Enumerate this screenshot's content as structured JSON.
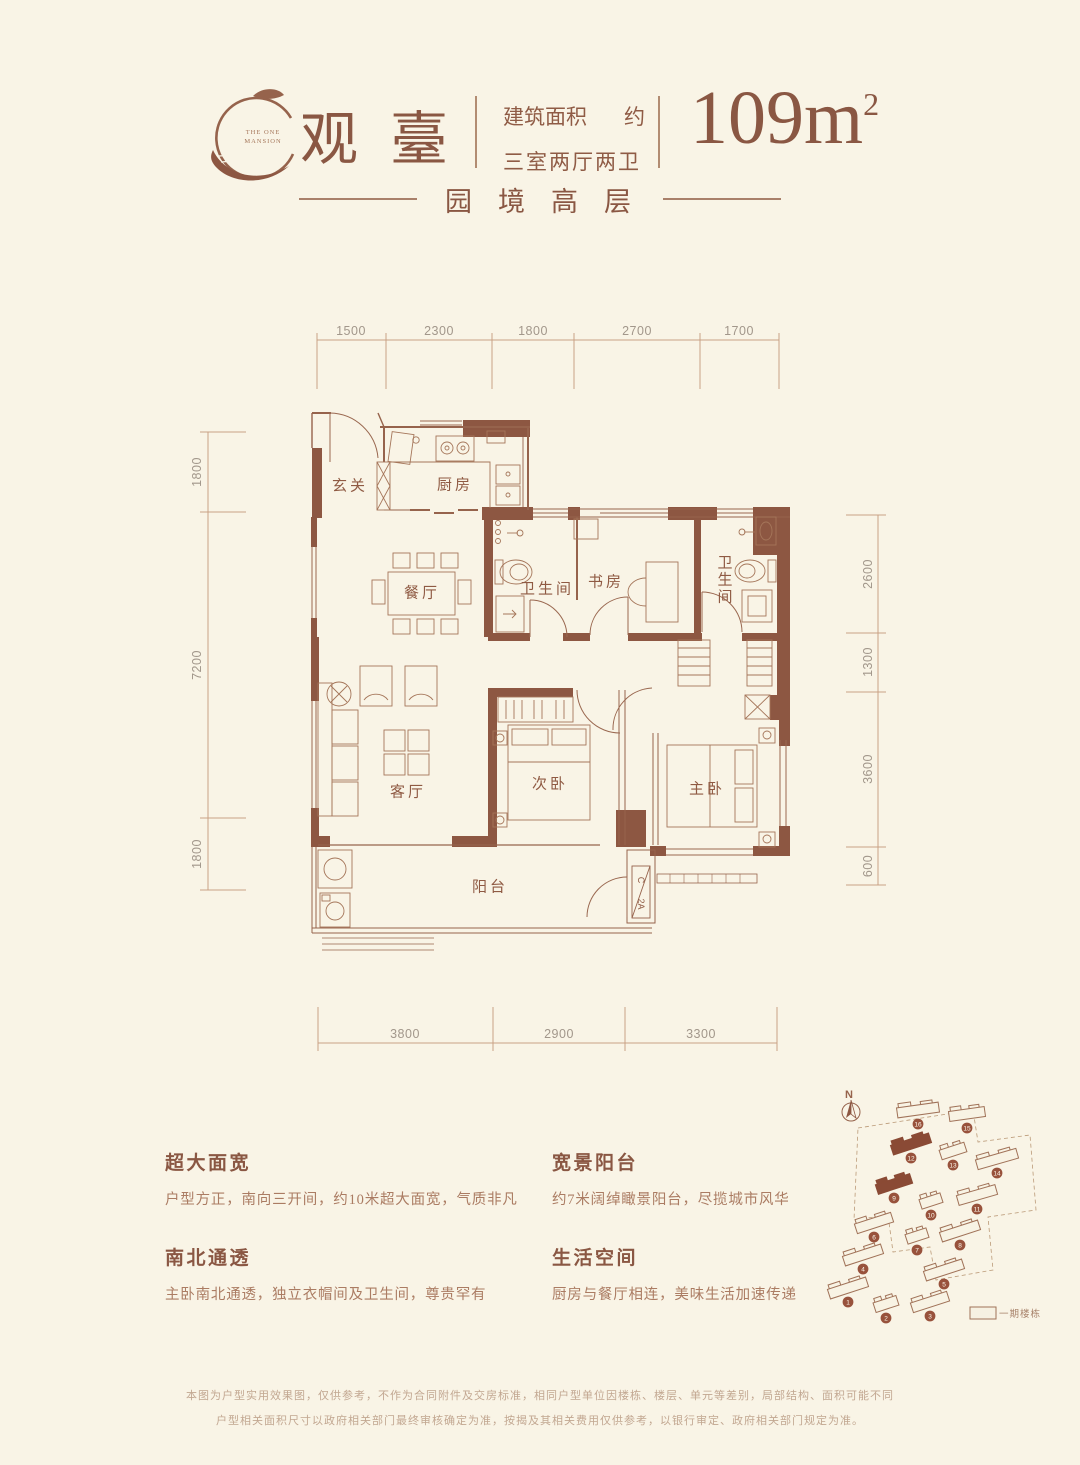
{
  "header": {
    "logo_caption_1": "THE ONE",
    "logo_caption_2": "MANSION",
    "title": "观臺",
    "area_label": "建筑面积",
    "area_approx": "约",
    "layout_label": "三室两厅两卫",
    "area_value": "109m",
    "area_sup": "2",
    "subtitle": "园境高层"
  },
  "floorplan": {
    "rooms": {
      "foyer": "玄关",
      "kitchen": "厨房",
      "dining": "餐厅",
      "bath1": "卫生间",
      "study": "书房",
      "bath2": "卫生间",
      "living": "客厅",
      "bedroom2": "次卧",
      "master": "主卧",
      "balcony": "阳台"
    },
    "ac_top": "C",
    "ac_bottom": "2A",
    "dims": {
      "top": [
        "1500",
        "2300",
        "1800",
        "2700",
        "1700"
      ],
      "left": [
        "1800",
        "7200",
        "1800"
      ],
      "right": [
        "2600",
        "1300",
        "3600",
        "600"
      ],
      "bottom": [
        "3800",
        "2900",
        "3300"
      ]
    }
  },
  "features": [
    {
      "title": "超大面宽",
      "desc": "户型方正，南向三开间，约10米超大面宽，气质非凡"
    },
    {
      "title": "南北通透",
      "desc": "主卧南北通透，独立衣帽间及卫生间，尊贵罕有"
    },
    {
      "title": "宽景阳台",
      "desc": "约7米阔绰瞰景阳台，尽揽城市风华"
    },
    {
      "title": "生活空间",
      "desc": "厨房与餐厅相连，美味生活加速传递"
    }
  ],
  "siteplan": {
    "north_label": "N",
    "legend_label": "一期楼栋",
    "buildings": [
      {
        "n": "16",
        "x": 100,
        "y": 30,
        "w": 42,
        "r": -8,
        "f": false
      },
      {
        "n": "15",
        "x": 149,
        "y": 34,
        "w": 36,
        "r": -8,
        "f": false
      },
      {
        "n": "12",
        "x": 93,
        "y": 64,
        "w": 40,
        "r": -18,
        "f": true
      },
      {
        "n": "13",
        "x": 135,
        "y": 71,
        "w": 26,
        "r": -18,
        "f": false
      },
      {
        "n": "14",
        "x": 179,
        "y": 79,
        "w": 42,
        "r": -16,
        "f": false
      },
      {
        "n": "9",
        "x": 76,
        "y": 104,
        "w": 36,
        "r": -18,
        "f": true
      },
      {
        "n": "10",
        "x": 113,
        "y": 121,
        "w": 22,
        "r": -18,
        "f": false
      },
      {
        "n": "11",
        "x": 159,
        "y": 115,
        "w": 40,
        "r": -16,
        "f": false
      },
      {
        "n": "6",
        "x": 56,
        "y": 143,
        "w": 38,
        "r": -18,
        "f": false
      },
      {
        "n": "7",
        "x": 99,
        "y": 156,
        "w": 22,
        "r": -18,
        "f": false
      },
      {
        "n": "8",
        "x": 142,
        "y": 151,
        "w": 40,
        "r": -18,
        "f": false
      },
      {
        "n": "4",
        "x": 45,
        "y": 175,
        "w": 40,
        "r": -18,
        "f": false
      },
      {
        "n": "5",
        "x": 126,
        "y": 190,
        "w": 40,
        "r": -18,
        "f": false
      },
      {
        "n": "1",
        "x": 30,
        "y": 208,
        "w": 40,
        "r": -18,
        "f": false
      },
      {
        "n": "2",
        "x": 68,
        "y": 224,
        "w": 24,
        "r": -18,
        "f": false
      },
      {
        "n": "3",
        "x": 112,
        "y": 222,
        "w": 38,
        "r": -18,
        "f": false
      }
    ]
  },
  "disclaimer": [
    "本图为户型实用效果图，仅供参考，不作为合同附件及交房标准，相同户型单位因楼栋、楼层、单元等差别，局部结构、面积可能不同",
    "户型相关面积尺寸以政府相关部门最终审核确定为准，按揭及其相关费用仅供参考，以银行审定、政府相关部门规定为准。"
  ]
}
